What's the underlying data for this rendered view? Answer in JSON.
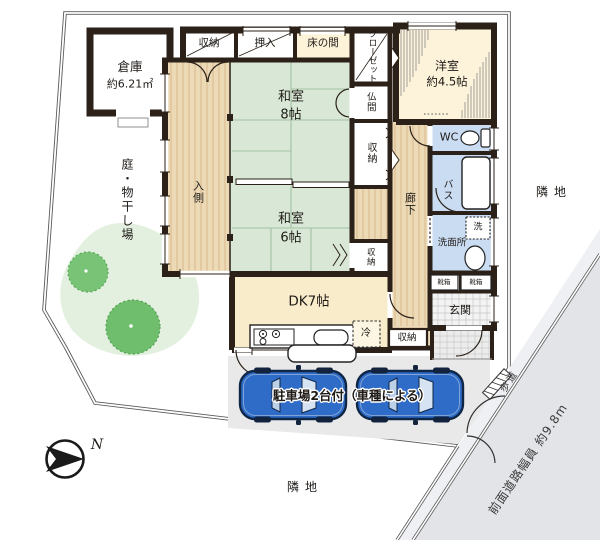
{
  "site": {
    "garden_label": "庭・物干し場",
    "neighbor_right": "隣地",
    "neighbor_bottom": "隣地",
    "sidewalk": "歩道",
    "front_road": "前面道路幅員 約9.8m",
    "parking": "駐車場2台付（車種による）",
    "north": "N"
  },
  "outbuilding": {
    "name": "倉庫",
    "area": "約6.21㎡"
  },
  "rooms": {
    "storage_top": "収納",
    "oshiire": "押入",
    "tokonoma": "床の間",
    "closet": "クローゼット",
    "western": {
      "name": "洋室",
      "size": "約4.5帖"
    },
    "butsuma": "仏間",
    "washitsu8": {
      "name": "和室",
      "size": "8帖"
    },
    "irigawa": "入側",
    "storage_mid": "収納",
    "hallway": "廊下",
    "wc": "WC",
    "bath": "バス",
    "washer": "洗",
    "washroom": "洗面所",
    "washitsu6": {
      "name": "和室",
      "size": "6帖"
    },
    "storage_tatami6": "収納",
    "shoebox_left": "靴箱",
    "shoebox_right": "靴箱",
    "entrance": "玄関",
    "storage_entrance": "収納",
    "dk": "DK7帖",
    "fridge": "冷"
  },
  "colors": {
    "wall": "#2b2118",
    "tatami": "#d9e8d6",
    "wood": "#ecdab6",
    "cream": "#fbf2d8",
    "water_room": "#cadcf2",
    "road": "#e3e4e8",
    "sidewalk": "#eef0f3",
    "tree": "#72c070",
    "garden": "#e3f0e0",
    "car": "#2e6cc8",
    "parking_bg": "#e9e9e9"
  }
}
